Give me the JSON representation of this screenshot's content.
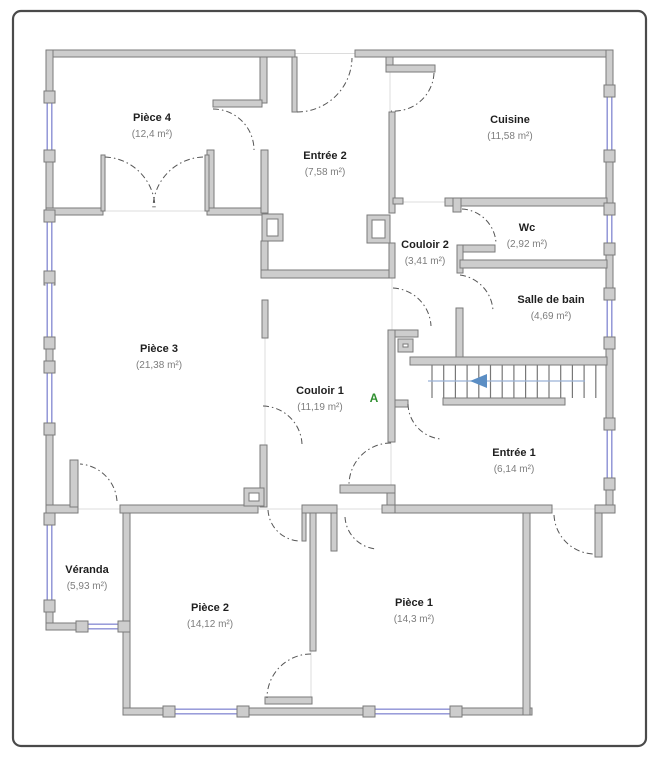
{
  "plan": {
    "marker": "A",
    "rooms": [
      {
        "id": "piece-4",
        "name": "Pièce 4",
        "area": "(12,4 m²)"
      },
      {
        "id": "entree-2",
        "name": "Entrée 2",
        "area": "(7,58 m²)"
      },
      {
        "id": "cuisine",
        "name": "Cuisine",
        "area": "(11,58 m²)"
      },
      {
        "id": "wc",
        "name": "Wc",
        "area": "(2,92 m²)"
      },
      {
        "id": "couloir-2",
        "name": "Couloir 2",
        "area": "(3,41 m²)"
      },
      {
        "id": "salle-de-bain",
        "name": "Salle de bain",
        "area": "(4,69 m²)"
      },
      {
        "id": "piece-3",
        "name": "Pièce 3",
        "area": "(21,38 m²)"
      },
      {
        "id": "couloir-1",
        "name": "Couloir 1",
        "area": "(11,19 m²)"
      },
      {
        "id": "entree-1",
        "name": "Entrée 1",
        "area": "(6,14 m²)"
      },
      {
        "id": "veranda",
        "name": "Véranda",
        "area": "(5,93 m²)"
      },
      {
        "id": "piece-2",
        "name": "Pièce 2",
        "area": "(14,12 m²)"
      },
      {
        "id": "piece-1",
        "name": "Pièce 1",
        "area": "(14,3 m²)"
      }
    ],
    "colors": {
      "wall_fill": "#cdcdcd",
      "wall_stroke": "#7a7a7a",
      "window": "#8b8fd4",
      "door_arc": "#555555",
      "stair_arrow": "#5b8ec4",
      "stair_line": "#9ab2d6",
      "marker": "#2f8f2f",
      "frame": "#4a4a4a",
      "guide": "#dcdcdc"
    }
  }
}
